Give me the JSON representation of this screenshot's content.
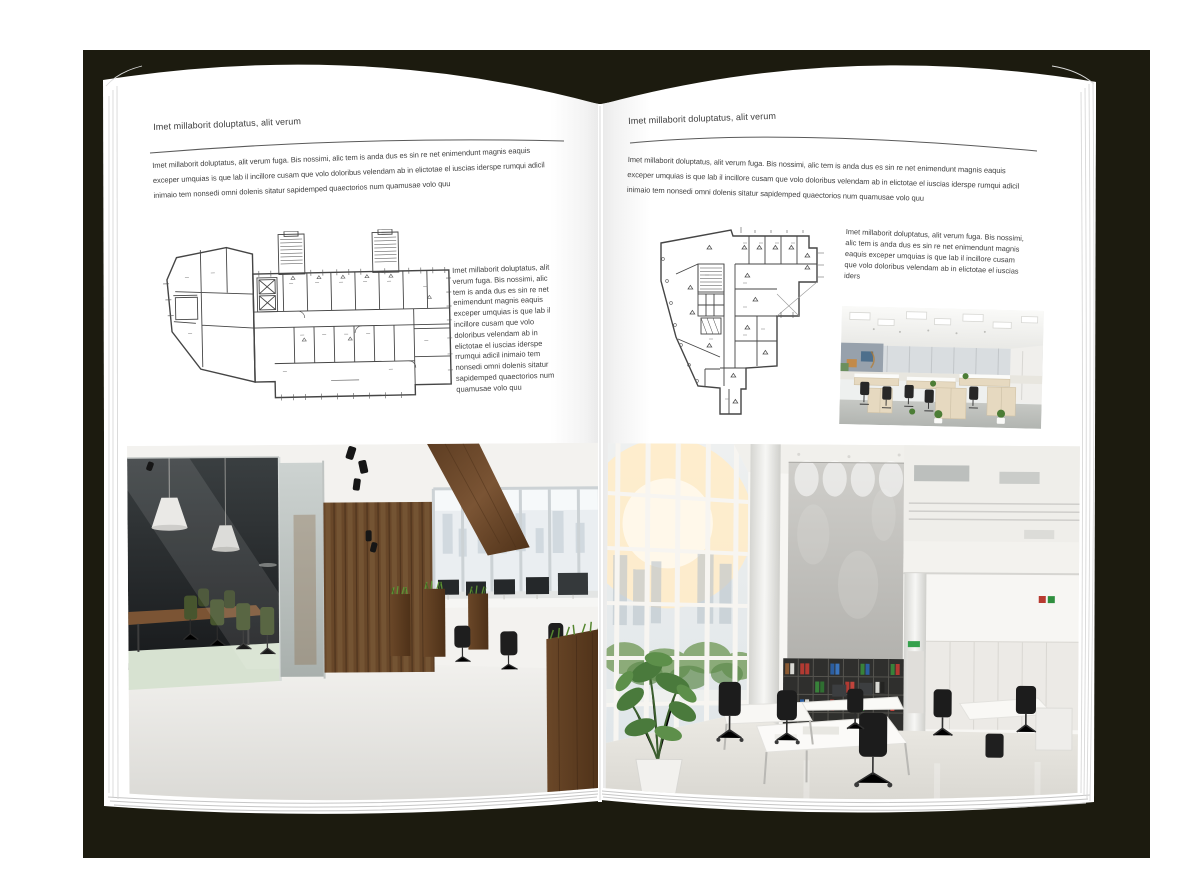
{
  "colors": {
    "backdrop": "#1c1b0f",
    "page": "#ffffff",
    "body_text": "#414141",
    "rule": "#5a5a5a",
    "plan_lines": "#454545"
  },
  "left_page": {
    "header": "Imet millaborit doluptatus, alit verum",
    "intro": "Imet millaborit doluptatus, alit verum fuga. Bis nossimi, alic tem is anda dus es sin re net enimendunt magnis eaquis exceper umquias is que lab il incillore cusam que volo doloribus velendam ab in elictotae el iuscias iderspe rumqui adicil inimaio tem nonsedi omni dolenis sitatur sapidemped quaectorios num quamusae volo quu",
    "side_text": "Imet millaborit doluptatus, alit verum fuga. Bis nossimi, alic tem is anda dus es sin re net enimendunt magnis eaquis exceper umquias is que lab il incillore cusam que volo doloribus velendam ab in elictotae el iuscias iderspe rrumqui adicil inimaio tem nonsedi omni dolenis sitatur sapidemped quaectorios num quamusae volo quu",
    "floor_plan": "rectangular office building floor plan with two stair towers",
    "photo": "dark loft office with glass meeting room, green chairs and wood plank wall"
  },
  "right_page": {
    "header": "Imet millaborit doluptatus, alit verum",
    "intro": "Imet millaborit doluptatus, alit verum fuga. Bis nossimi, alic tem is anda dus es sin re net enimendunt magnis eaquis exceper umquias is que lab il incillore cusam que volo doloribus velendam ab in elictotae el iuscias iderspe rumqui adicil inimaio tem nonsedi omni dolenis sitatur sapidemped quaectorios num quamusae volo quu",
    "side_text": "Imet millaborit doluptatus, alit verum fuga. Bis nossimi, alic tem is anda dus es sin re net eni­mendunt magnis eaquis exceper umquias is que lab il incillore cusam que volo doloribus velendam ab in elictotae el iuscias iders",
    "floor_plan": "irregular multi-room office floor plan",
    "photo_small": "bright open-plan office with rows of light-wood desks",
    "photo": "double-height white office with bookshelves, columns and large windows"
  }
}
